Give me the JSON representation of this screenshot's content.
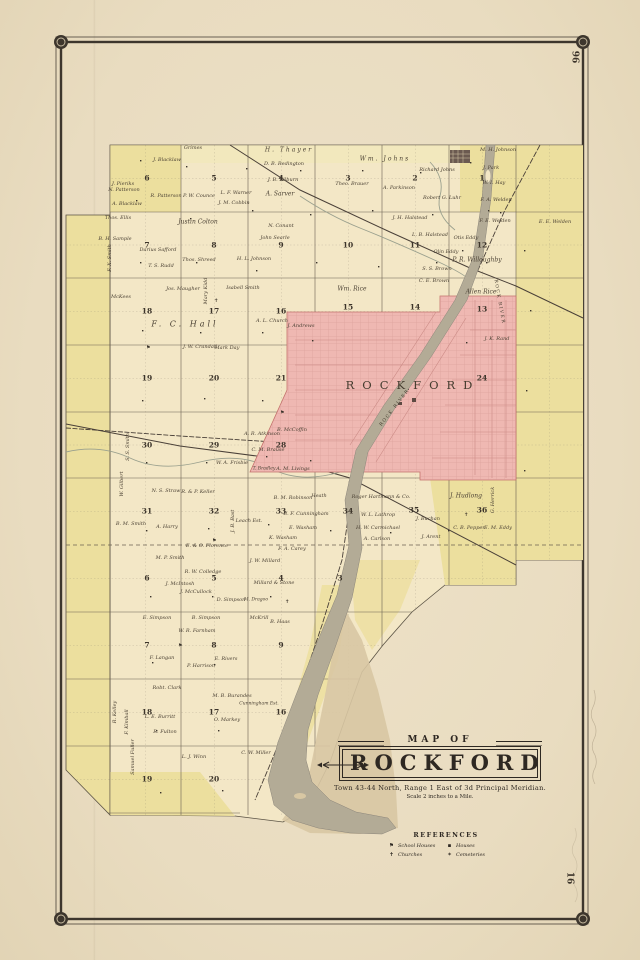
{
  "page": {
    "number_top": "96",
    "number_bottom": "16"
  },
  "cartouche": {
    "map_of": "MAP OF",
    "title": "ROCKFORD",
    "subtitle": "Town 43-44 North, Range 1 East of 3d Principal Meridian.",
    "scale": "Scale 2 inches to a Mile."
  },
  "references": {
    "heading": "REFERENCES",
    "items": [
      {
        "icon": "schoolhouse-icon",
        "glyph": "⚑",
        "label": "School Houses"
      },
      {
        "icon": "church-icon",
        "glyph": "✝",
        "label": "Churches"
      },
      {
        "icon": "house-icon",
        "glyph": "▪",
        "label": "Houses"
      },
      {
        "icon": "cemetery-icon",
        "glyph": "✶",
        "label": "Cemeteries"
      }
    ]
  },
  "colors": {
    "paper": "#ebdfc6",
    "map_cream": "#f3e7c6",
    "band_yellow": "#ecdf9e",
    "pale_yellow": "#f2e8bd",
    "city_pink": "#efb8b2",
    "river_gray": "#b3ab96",
    "sand": "#d8c7a3",
    "ink": "#3a332a"
  },
  "map": {
    "map_labels": [
      {
        "t": "ROCKFORD",
        "x": 413,
        "y": 385,
        "s": 11.5,
        "ls": 8
      },
      {
        "t": "ROCK RIVER",
        "x": 499,
        "y": 302,
        "r": 80,
        "s": 4.5,
        "ls": 1.5
      },
      {
        "t": "ROCK RIVER",
        "x": 395,
        "y": 408,
        "r": -52,
        "s": 4.5,
        "ls": 1.5
      }
    ],
    "section_numbers": [
      {
        "n": "6",
        "x": 147,
        "y": 178
      },
      {
        "n": "5",
        "x": 214,
        "y": 178
      },
      {
        "n": "4",
        "x": 281,
        "y": 178
      },
      {
        "n": "3",
        "x": 348,
        "y": 178
      },
      {
        "n": "2",
        "x": 415,
        "y": 178
      },
      {
        "n": "1",
        "x": 482,
        "y": 178
      },
      {
        "n": "7",
        "x": 147,
        "y": 245
      },
      {
        "n": "8",
        "x": 214,
        "y": 245
      },
      {
        "n": "9",
        "x": 281,
        "y": 245
      },
      {
        "n": "10",
        "x": 348,
        "y": 245
      },
      {
        "n": "11",
        "x": 415,
        "y": 245
      },
      {
        "n": "12",
        "x": 482,
        "y": 245
      },
      {
        "n": "18",
        "x": 147,
        "y": 311
      },
      {
        "n": "17",
        "x": 214,
        "y": 311
      },
      {
        "n": "16",
        "x": 281,
        "y": 311
      },
      {
        "n": "15",
        "x": 348,
        "y": 307
      },
      {
        "n": "14",
        "x": 415,
        "y": 307
      },
      {
        "n": "13",
        "x": 482,
        "y": 309
      },
      {
        "n": "19",
        "x": 147,
        "y": 378
      },
      {
        "n": "20",
        "x": 214,
        "y": 378
      },
      {
        "n": "21",
        "x": 281,
        "y": 378
      },
      {
        "n": "24",
        "x": 482,
        "y": 378
      },
      {
        "n": "30",
        "x": 147,
        "y": 445
      },
      {
        "n": "29",
        "x": 214,
        "y": 445
      },
      {
        "n": "28",
        "x": 281,
        "y": 445
      },
      {
        "n": "31",
        "x": 147,
        "y": 511
      },
      {
        "n": "32",
        "x": 214,
        "y": 511
      },
      {
        "n": "33",
        "x": 281,
        "y": 511
      },
      {
        "n": "34",
        "x": 348,
        "y": 511
      },
      {
        "n": "35",
        "x": 414,
        "y": 510
      },
      {
        "n": "36",
        "x": 482,
        "y": 510
      },
      {
        "n": "6",
        "x": 147,
        "y": 578
      },
      {
        "n": "5",
        "x": 214,
        "y": 578
      },
      {
        "n": "4",
        "x": 281,
        "y": 578
      },
      {
        "n": "3",
        "x": 340,
        "y": 578
      },
      {
        "n": "7",
        "x": 147,
        "y": 645
      },
      {
        "n": "8",
        "x": 214,
        "y": 645
      },
      {
        "n": "9",
        "x": 281,
        "y": 645
      },
      {
        "n": "18",
        "x": 147,
        "y": 712
      },
      {
        "n": "17",
        "x": 214,
        "y": 712
      },
      {
        "n": "16",
        "x": 281,
        "y": 712
      },
      {
        "n": "19",
        "x": 147,
        "y": 779
      },
      {
        "n": "20",
        "x": 214,
        "y": 779
      }
    ],
    "landowners": [
      {
        "t": "J. Pieriks",
        "x": 123,
        "y": 184
      },
      {
        "t": "J. Blacklaw",
        "x": 167,
        "y": 160
      },
      {
        "t": "A. Blacklaw",
        "x": 127,
        "y": 204
      },
      {
        "t": "N. Patterson",
        "x": 124,
        "y": 190
      },
      {
        "t": "R. Patterson",
        "x": 166,
        "y": 196
      },
      {
        "t": "Grimes",
        "x": 193,
        "y": 148
      },
      {
        "t": "H. Thayer",
        "x": 289,
        "y": 150,
        "s": 6,
        "ls": 2
      },
      {
        "t": "D. B. Redington",
        "x": 284,
        "y": 164
      },
      {
        "t": "J. B. Kilburn",
        "x": 283,
        "y": 180
      },
      {
        "t": "A. Sarver",
        "x": 280,
        "y": 194,
        "s": 6
      },
      {
        "t": "P. W. Counce",
        "x": 199,
        "y": 196
      },
      {
        "t": "L. F. Warner",
        "x": 236,
        "y": 193
      },
      {
        "t": "J. M. Cobbin",
        "x": 234,
        "y": 203
      },
      {
        "t": "Justin Colton",
        "x": 198,
        "y": 222,
        "s": 6
      },
      {
        "t": "N. Conant",
        "x": 281,
        "y": 226
      },
      {
        "t": "John Searle",
        "x": 275,
        "y": 238
      },
      {
        "t": "Wm. Johns",
        "x": 385,
        "y": 159,
        "s": 6,
        "ls": 2
      },
      {
        "t": "Richard Johns",
        "x": 437,
        "y": 170
      },
      {
        "t": "J. Park",
        "x": 491,
        "y": 168
      },
      {
        "t": "W. I. Hay",
        "x": 494,
        "y": 183
      },
      {
        "t": "M. H. Johnson",
        "x": 498,
        "y": 150
      },
      {
        "t": "Theo. Brauer",
        "x": 352,
        "y": 184
      },
      {
        "t": "A. Parkinson",
        "x": 399,
        "y": 188
      },
      {
        "t": "Robert G. Luhr",
        "x": 442,
        "y": 198
      },
      {
        "t": "F. A. Welden",
        "x": 496,
        "y": 200
      },
      {
        "t": "F. E. Welden",
        "x": 495,
        "y": 221
      },
      {
        "t": "E. E. Welden",
        "x": 555,
        "y": 222
      },
      {
        "t": "J. H. Halstead",
        "x": 410,
        "y": 218
      },
      {
        "t": "L. B. Halstead",
        "x": 430,
        "y": 235
      },
      {
        "t": "Otis Eddy",
        "x": 466,
        "y": 238
      },
      {
        "t": "Thos. Ellis",
        "x": 118,
        "y": 218
      },
      {
        "t": "B. H. Sample",
        "x": 115,
        "y": 239
      },
      {
        "t": "Darius Safford",
        "x": 158,
        "y": 250
      },
      {
        "t": "T. S. Rudd",
        "x": 161,
        "y": 266
      },
      {
        "t": "Thos. Shreed",
        "x": 199,
        "y": 260
      },
      {
        "t": "H. L. Johnson",
        "x": 254,
        "y": 259
      },
      {
        "t": "Jos. Maugher",
        "x": 183,
        "y": 289
      },
      {
        "t": "Isabell Smith",
        "x": 243,
        "y": 288
      },
      {
        "t": "McKees",
        "x": 121,
        "y": 297
      },
      {
        "t": "Mary Kidd",
        "x": 206,
        "y": 291,
        "r": -90
      },
      {
        "t": "F. C. Hall",
        "x": 185,
        "y": 324,
        "s": 8,
        "ls": 3
      },
      {
        "t": "A. L. Church",
        "x": 272,
        "y": 321
      },
      {
        "t": "J. Andrews",
        "x": 301,
        "y": 326
      },
      {
        "t": "J. W. Crandall",
        "x": 200,
        "y": 347
      },
      {
        "t": "Mark Day",
        "x": 227,
        "y": 348
      },
      {
        "t": "Wm. Rice",
        "x": 352,
        "y": 289,
        "s": 6
      },
      {
        "t": "S. S. Brown",
        "x": 437,
        "y": 269
      },
      {
        "t": "C. E. Brown",
        "x": 434,
        "y": 281
      },
      {
        "t": "P. R. Willoughby",
        "x": 477,
        "y": 260,
        "s": 6
      },
      {
        "t": "Olin Eddy",
        "x": 446,
        "y": 252
      },
      {
        "t": "Allen Rice",
        "x": 481,
        "y": 292,
        "s": 6
      },
      {
        "t": "J. K. Rand",
        "x": 497,
        "y": 339
      },
      {
        "t": "F. X. Smith",
        "x": 110,
        "y": 258,
        "r": -90
      },
      {
        "t": "S. S. Smith",
        "x": 128,
        "y": 447,
        "r": -90
      },
      {
        "t": "W. Gilbert",
        "x": 122,
        "y": 484,
        "r": -90
      },
      {
        "t": "B. M. Smith",
        "x": 131,
        "y": 524
      },
      {
        "t": "A. Harry",
        "x": 167,
        "y": 527
      },
      {
        "t": "N. S. Straw",
        "x": 166,
        "y": 491
      },
      {
        "t": "R. & P. Keller",
        "x": 198,
        "y": 492
      },
      {
        "t": "W. A. Frisbie",
        "x": 232,
        "y": 463
      },
      {
        "t": "C. M. Brause",
        "x": 268,
        "y": 450
      },
      {
        "t": "A. M. Livings",
        "x": 293,
        "y": 469
      },
      {
        "t": "T. Bradley",
        "x": 264,
        "y": 469,
        "s": 4.5
      },
      {
        "t": "B. McCoffin",
        "x": 292,
        "y": 430
      },
      {
        "t": "A. R. Atkinson",
        "x": 262,
        "y": 434
      },
      {
        "t": "Leach Est.",
        "x": 249,
        "y": 521
      },
      {
        "t": "J. B. Bast",
        "x": 233,
        "y": 521,
        "r": -90
      },
      {
        "t": "B. M. Robinson",
        "x": 293,
        "y": 498
      },
      {
        "t": "Heath",
        "x": 319,
        "y": 496
      },
      {
        "t": "B. F. Cunningham",
        "x": 306,
        "y": 514
      },
      {
        "t": "E. Washam",
        "x": 303,
        "y": 528
      },
      {
        "t": "K. Washam",
        "x": 283,
        "y": 538
      },
      {
        "t": "F. A. Carey",
        "x": 292,
        "y": 549
      },
      {
        "t": "Roger Hartmann & Co.",
        "x": 381,
        "y": 497
      },
      {
        "t": "W. L. Lathrop",
        "x": 378,
        "y": 515
      },
      {
        "t": "H. W. Carmichael",
        "x": 378,
        "y": 528
      },
      {
        "t": "A. Carlson",
        "x": 377,
        "y": 539
      },
      {
        "t": "J. Buchan",
        "x": 428,
        "y": 519
      },
      {
        "t": "J. Arent",
        "x": 431,
        "y": 537
      },
      {
        "t": "J. Hudlong",
        "x": 466,
        "y": 496,
        "s": 6
      },
      {
        "t": "C. B. Pepper",
        "x": 469,
        "y": 528
      },
      {
        "t": "E. M. Eddy",
        "x": 498,
        "y": 528
      },
      {
        "t": "G. Herrick",
        "x": 493,
        "y": 500,
        "r": -90
      },
      {
        "t": "M. P. Smith",
        "x": 170,
        "y": 558
      },
      {
        "t": "E. & O. Florence",
        "x": 207,
        "y": 546
      },
      {
        "t": "R. W. Colledge",
        "x": 203,
        "y": 572
      },
      {
        "t": "J. W. Millard",
        "x": 265,
        "y": 561
      },
      {
        "t": "Millard & Stone",
        "x": 274,
        "y": 583
      },
      {
        "t": "J. McIntosh",
        "x": 180,
        "y": 584
      },
      {
        "t": "J. McCullock",
        "x": 196,
        "y": 592
      },
      {
        "t": "D. Simpson",
        "x": 231,
        "y": 600
      },
      {
        "t": "M. Dragoo",
        "x": 256,
        "y": 600,
        "s": 4.5
      },
      {
        "t": "E. Simpson",
        "x": 157,
        "y": 618
      },
      {
        "t": "B. Simpson",
        "x": 206,
        "y": 618
      },
      {
        "t": "W. R. Farnham",
        "x": 197,
        "y": 631
      },
      {
        "t": "McKrill",
        "x": 259,
        "y": 618
      },
      {
        "t": "B. Haas",
        "x": 280,
        "y": 622
      },
      {
        "t": "F. Langan",
        "x": 162,
        "y": 658
      },
      {
        "t": "P. Harrison",
        "x": 201,
        "y": 666
      },
      {
        "t": "E. Rivers",
        "x": 226,
        "y": 659
      },
      {
        "t": "Robt. Clark",
        "x": 167,
        "y": 688
      },
      {
        "t": "M. B. Burandes",
        "x": 232,
        "y": 696
      },
      {
        "t": "Cunningham Est.",
        "x": 259,
        "y": 704,
        "s": 4.5
      },
      {
        "t": "O. Markey",
        "x": 227,
        "y": 720
      },
      {
        "t": "L. E. Burritt",
        "x": 160,
        "y": 717
      },
      {
        "t": "R. Fulton",
        "x": 165,
        "y": 732
      },
      {
        "t": "C. W. Miller",
        "x": 256,
        "y": 753
      },
      {
        "t": "L. J. Winn",
        "x": 194,
        "y": 757
      },
      {
        "t": "Samuel Fuller",
        "x": 133,
        "y": 757,
        "r": -90
      },
      {
        "t": "R. Kelley",
        "x": 115,
        "y": 712,
        "r": -90
      },
      {
        "t": "F. Kimball",
        "x": 127,
        "y": 722,
        "r": -90
      }
    ]
  }
}
